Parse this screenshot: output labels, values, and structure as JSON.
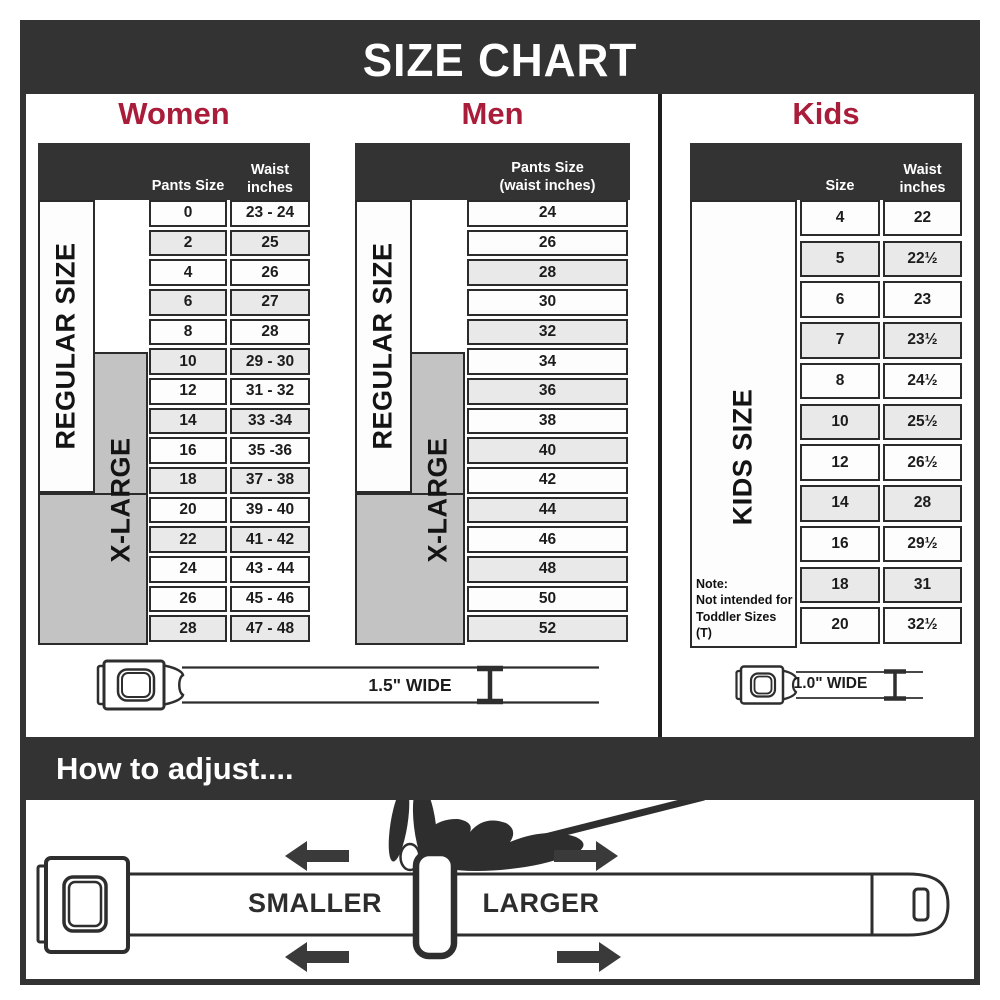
{
  "title": "SIZE CHART",
  "colors": {
    "accent": "#a91d3a",
    "dark": "#333333",
    "row_shaded": "#e9e9e9",
    "xlarge_gray": "#c3c3c3"
  },
  "sections": {
    "women": {
      "label": "Women",
      "col1_header": "Pants Size",
      "col2_header_line1": "Waist",
      "col2_header_line2": "inches",
      "regular_label": "REGULAR SIZE",
      "xlarge_label": "X-LARGE",
      "rows": [
        {
          "values": [
            "0",
            "23 - 24"
          ],
          "shaded": false
        },
        {
          "values": [
            "2",
            "25"
          ],
          "shaded": true
        },
        {
          "values": [
            "4",
            "26"
          ],
          "shaded": false
        },
        {
          "values": [
            "6",
            "27"
          ],
          "shaded": true
        },
        {
          "values": [
            "8",
            "28"
          ],
          "shaded": false
        },
        {
          "values": [
            "10",
            "29 - 30"
          ],
          "shaded": true
        },
        {
          "values": [
            "12",
            "31 - 32"
          ],
          "shaded": false
        },
        {
          "values": [
            "14",
            "33 -34"
          ],
          "shaded": true
        },
        {
          "values": [
            "16",
            "35 -36"
          ],
          "shaded": false
        },
        {
          "values": [
            "18",
            "37 - 38"
          ],
          "shaded": true
        },
        {
          "values": [
            "20",
            "39 - 40"
          ],
          "shaded": false
        },
        {
          "values": [
            "22",
            "41 - 42"
          ],
          "shaded": true
        },
        {
          "values": [
            "24",
            "43 - 44"
          ],
          "shaded": false
        },
        {
          "values": [
            "26",
            "45 - 46"
          ],
          "shaded": false
        },
        {
          "values": [
            "28",
            "47 - 48"
          ],
          "shaded": true
        }
      ]
    },
    "men": {
      "label": "Men",
      "col_header_line1": "Pants Size",
      "col_header_line2": "(waist inches)",
      "regular_label": "REGULAR SIZE",
      "xlarge_label": "X-LARGE",
      "rows": [
        {
          "values": [
            "24"
          ],
          "shaded": false
        },
        {
          "values": [
            "26"
          ],
          "shaded": false
        },
        {
          "values": [
            "28"
          ],
          "shaded": true
        },
        {
          "values": [
            "30"
          ],
          "shaded": false
        },
        {
          "values": [
            "32"
          ],
          "shaded": true
        },
        {
          "values": [
            "34"
          ],
          "shaded": false
        },
        {
          "values": [
            "36"
          ],
          "shaded": true
        },
        {
          "values": [
            "38"
          ],
          "shaded": false
        },
        {
          "values": [
            "40"
          ],
          "shaded": true
        },
        {
          "values": [
            "42"
          ],
          "shaded": false
        },
        {
          "values": [
            "44"
          ],
          "shaded": true
        },
        {
          "values": [
            "46"
          ],
          "shaded": false
        },
        {
          "values": [
            "48"
          ],
          "shaded": true
        },
        {
          "values": [
            "50"
          ],
          "shaded": false
        },
        {
          "values": [
            "52"
          ],
          "shaded": true
        }
      ]
    },
    "kids": {
      "label": "Kids",
      "col1_header": "Size",
      "col2_header_line1": "Waist",
      "col2_header_line2": "inches",
      "side_label": "KIDS SIZE",
      "note_title": "Note:",
      "note_line1": "Not intended for",
      "note_line2": "Toddler Sizes (T)",
      "rows": [
        {
          "values": [
            "4",
            "22"
          ],
          "shaded": false
        },
        {
          "values": [
            "5",
            "22½"
          ],
          "shaded": true
        },
        {
          "values": [
            "6",
            "23"
          ],
          "shaded": false
        },
        {
          "values": [
            "7",
            "23½"
          ],
          "shaded": true
        },
        {
          "values": [
            "8",
            "24½"
          ],
          "shaded": false
        },
        {
          "values": [
            "10",
            "25½"
          ],
          "shaded": true
        },
        {
          "values": [
            "12",
            "26½"
          ],
          "shaded": false
        },
        {
          "values": [
            "14",
            "28"
          ],
          "shaded": true
        },
        {
          "values": [
            "16",
            "29½"
          ],
          "shaded": false
        },
        {
          "values": [
            "18",
            "31"
          ],
          "shaded": true
        },
        {
          "values": [
            "20",
            "32½"
          ],
          "shaded": false
        }
      ]
    }
  },
  "belts": {
    "adult_width_label": "1.5\" WIDE",
    "kids_width_label": "1.0\" WIDE"
  },
  "how_to_adjust": {
    "title": "How to adjust....",
    "smaller_label": "SMALLER",
    "larger_label": "LARGER"
  }
}
